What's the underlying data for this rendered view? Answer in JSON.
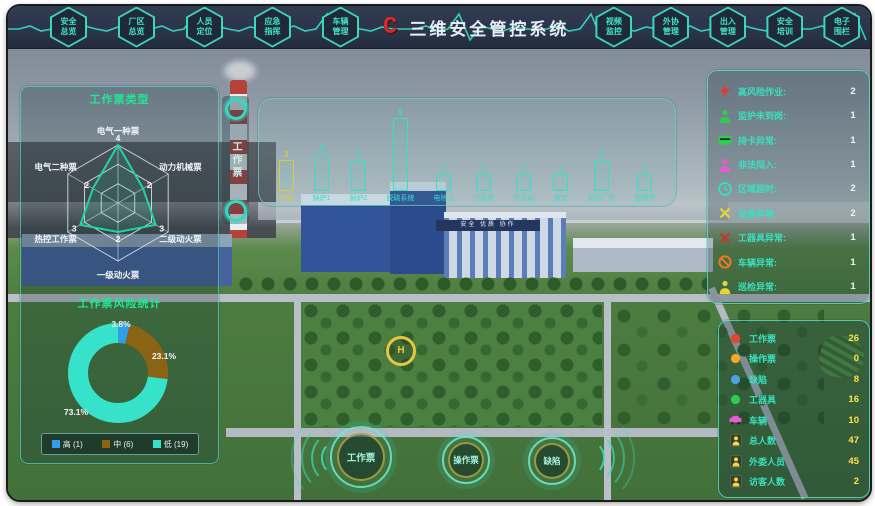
{
  "app": {
    "title": "三维安全管控系统",
    "logo_letter": "C"
  },
  "topbar": {
    "left_menu": [
      {
        "line1": "安全",
        "line2": "总览"
      },
      {
        "line1": "厂区",
        "line2": "总览"
      },
      {
        "line1": "人员",
        "line2": "定位"
      },
      {
        "line1": "应急",
        "line2": "指挥"
      },
      {
        "line1": "车辆",
        "line2": "管理"
      }
    ],
    "right_menu": [
      {
        "line1": "视频",
        "line2": "监控"
      },
      {
        "line1": "外协",
        "line2": "管理"
      },
      {
        "line1": "出入",
        "line2": "管理"
      },
      {
        "line1": "安全",
        "line2": "培训"
      },
      {
        "line1": "电子",
        "line2": "围栏"
      },
      {
        "line1": "安防",
        "line2": "设备"
      }
    ]
  },
  "side_tab": {
    "label": "工作票"
  },
  "chart_data": [
    {
      "id": "work-ticket-type-radar",
      "type": "radar",
      "title": "工作票类型",
      "categories": [
        "电气一种票",
        "动力机械票",
        "二级动火票",
        "一级动火票",
        "热控工作票",
        "电气二种票"
      ],
      "values": [
        4,
        2,
        3,
        2,
        3,
        2
      ],
      "max": 4,
      "rings": 3,
      "stroke": "#1fd6a3",
      "grid_color": "#e8eef2"
    },
    {
      "id": "work-ticket-risk-donut",
      "type": "pie",
      "title": "工作票风险统计",
      "segments": [
        {
          "label": "高 (1)",
          "value": 1,
          "pct": "3.8%",
          "color": "#2f9fe8"
        },
        {
          "label": "中 (6)",
          "value": 6,
          "pct": "23.1%",
          "color": "#8a6414"
        },
        {
          "label": "低 (19)",
          "value": 19,
          "pct": "73.1%",
          "color": "#36e2c9"
        }
      ],
      "total": 26,
      "legend_position": "bottom"
    },
    {
      "id": "area-ticket-bars",
      "type": "bar",
      "title": "",
      "categories": [
        "灰库",
        "锅炉1",
        "锅炉2",
        "脱硫系统",
        "电除尘",
        "汽机房",
        "升压站",
        "食堂",
        "封闭厂外",
        "围墙外"
      ],
      "values": [
        3,
        4,
        3,
        9,
        1,
        1,
        1,
        1,
        3,
        1
      ],
      "colors": [
        "#d9cb3a",
        "#35e0c8",
        "#35e0c8",
        "#35e0c8",
        "#35e0c8",
        "#35e0c8",
        "#35e0c8",
        "#35e0c8",
        "#35e0c8",
        "#35e0c8"
      ],
      "ylim": [
        0,
        9
      ]
    }
  ],
  "alarm_panel": {
    "items": [
      {
        "icon": "lightning",
        "color": "#e8352c",
        "label": "高风险作业:",
        "value": "2"
      },
      {
        "icon": "person",
        "color": "#2ecc52",
        "label": "监护未到岗:",
        "value": "1"
      },
      {
        "icon": "card",
        "color": "#2ecc52",
        "label": "持卡异常:",
        "value": "1"
      },
      {
        "icon": "person",
        "color": "#e85bd0",
        "label": "非法闯入:",
        "value": "1"
      },
      {
        "icon": "clock",
        "color": "#35e0c8",
        "label": "区域超时:",
        "value": "2"
      },
      {
        "icon": "tools",
        "color": "#e8d23a",
        "label": "设备异常:",
        "value": "2"
      },
      {
        "icon": "tools",
        "color": "#c33a2a",
        "label": "工器具异常:",
        "value": "1"
      },
      {
        "icon": "no-entry",
        "color": "#f07a20",
        "label": "车辆异常:",
        "value": "1"
      },
      {
        "icon": "person",
        "color": "#e8d23a",
        "label": "巡检异常:",
        "value": "1"
      }
    ]
  },
  "stats_panel": {
    "items": [
      {
        "icon": "dot",
        "color": "#e8432c",
        "label": "工作票",
        "value": "26"
      },
      {
        "icon": "dot",
        "color": "#f5a623",
        "label": "操作票",
        "value": "0"
      },
      {
        "icon": "dot",
        "color": "#4aa3df",
        "label": "缺陷",
        "value": "8"
      },
      {
        "icon": "dot",
        "color": "#2ecc52",
        "label": "工器具",
        "value": "16"
      },
      {
        "icon": "car",
        "color": "#e85bd0",
        "label": "车辆",
        "value": "10"
      },
      {
        "icon": "person-badge",
        "color": "#ffd24a",
        "label": "总人数",
        "value": "47"
      },
      {
        "icon": "person-badge",
        "color": "#ffd24a",
        "label": "外委人员",
        "value": "45"
      },
      {
        "icon": "person-badge",
        "color": "#ffd24a",
        "label": "访客人数",
        "value": "2"
      }
    ]
  },
  "bottom_buttons": [
    {
      "label": "工作票"
    },
    {
      "label": "操作票"
    },
    {
      "label": "缺陷"
    }
  ],
  "scene": {
    "banner": "安全 优质 协作",
    "helipad_letter": "H"
  },
  "colors": {
    "accent": "#35e0c8",
    "panel_border": "#5ce2d0",
    "value_yellow": "#ffe34d",
    "title_green": "#22e698"
  }
}
